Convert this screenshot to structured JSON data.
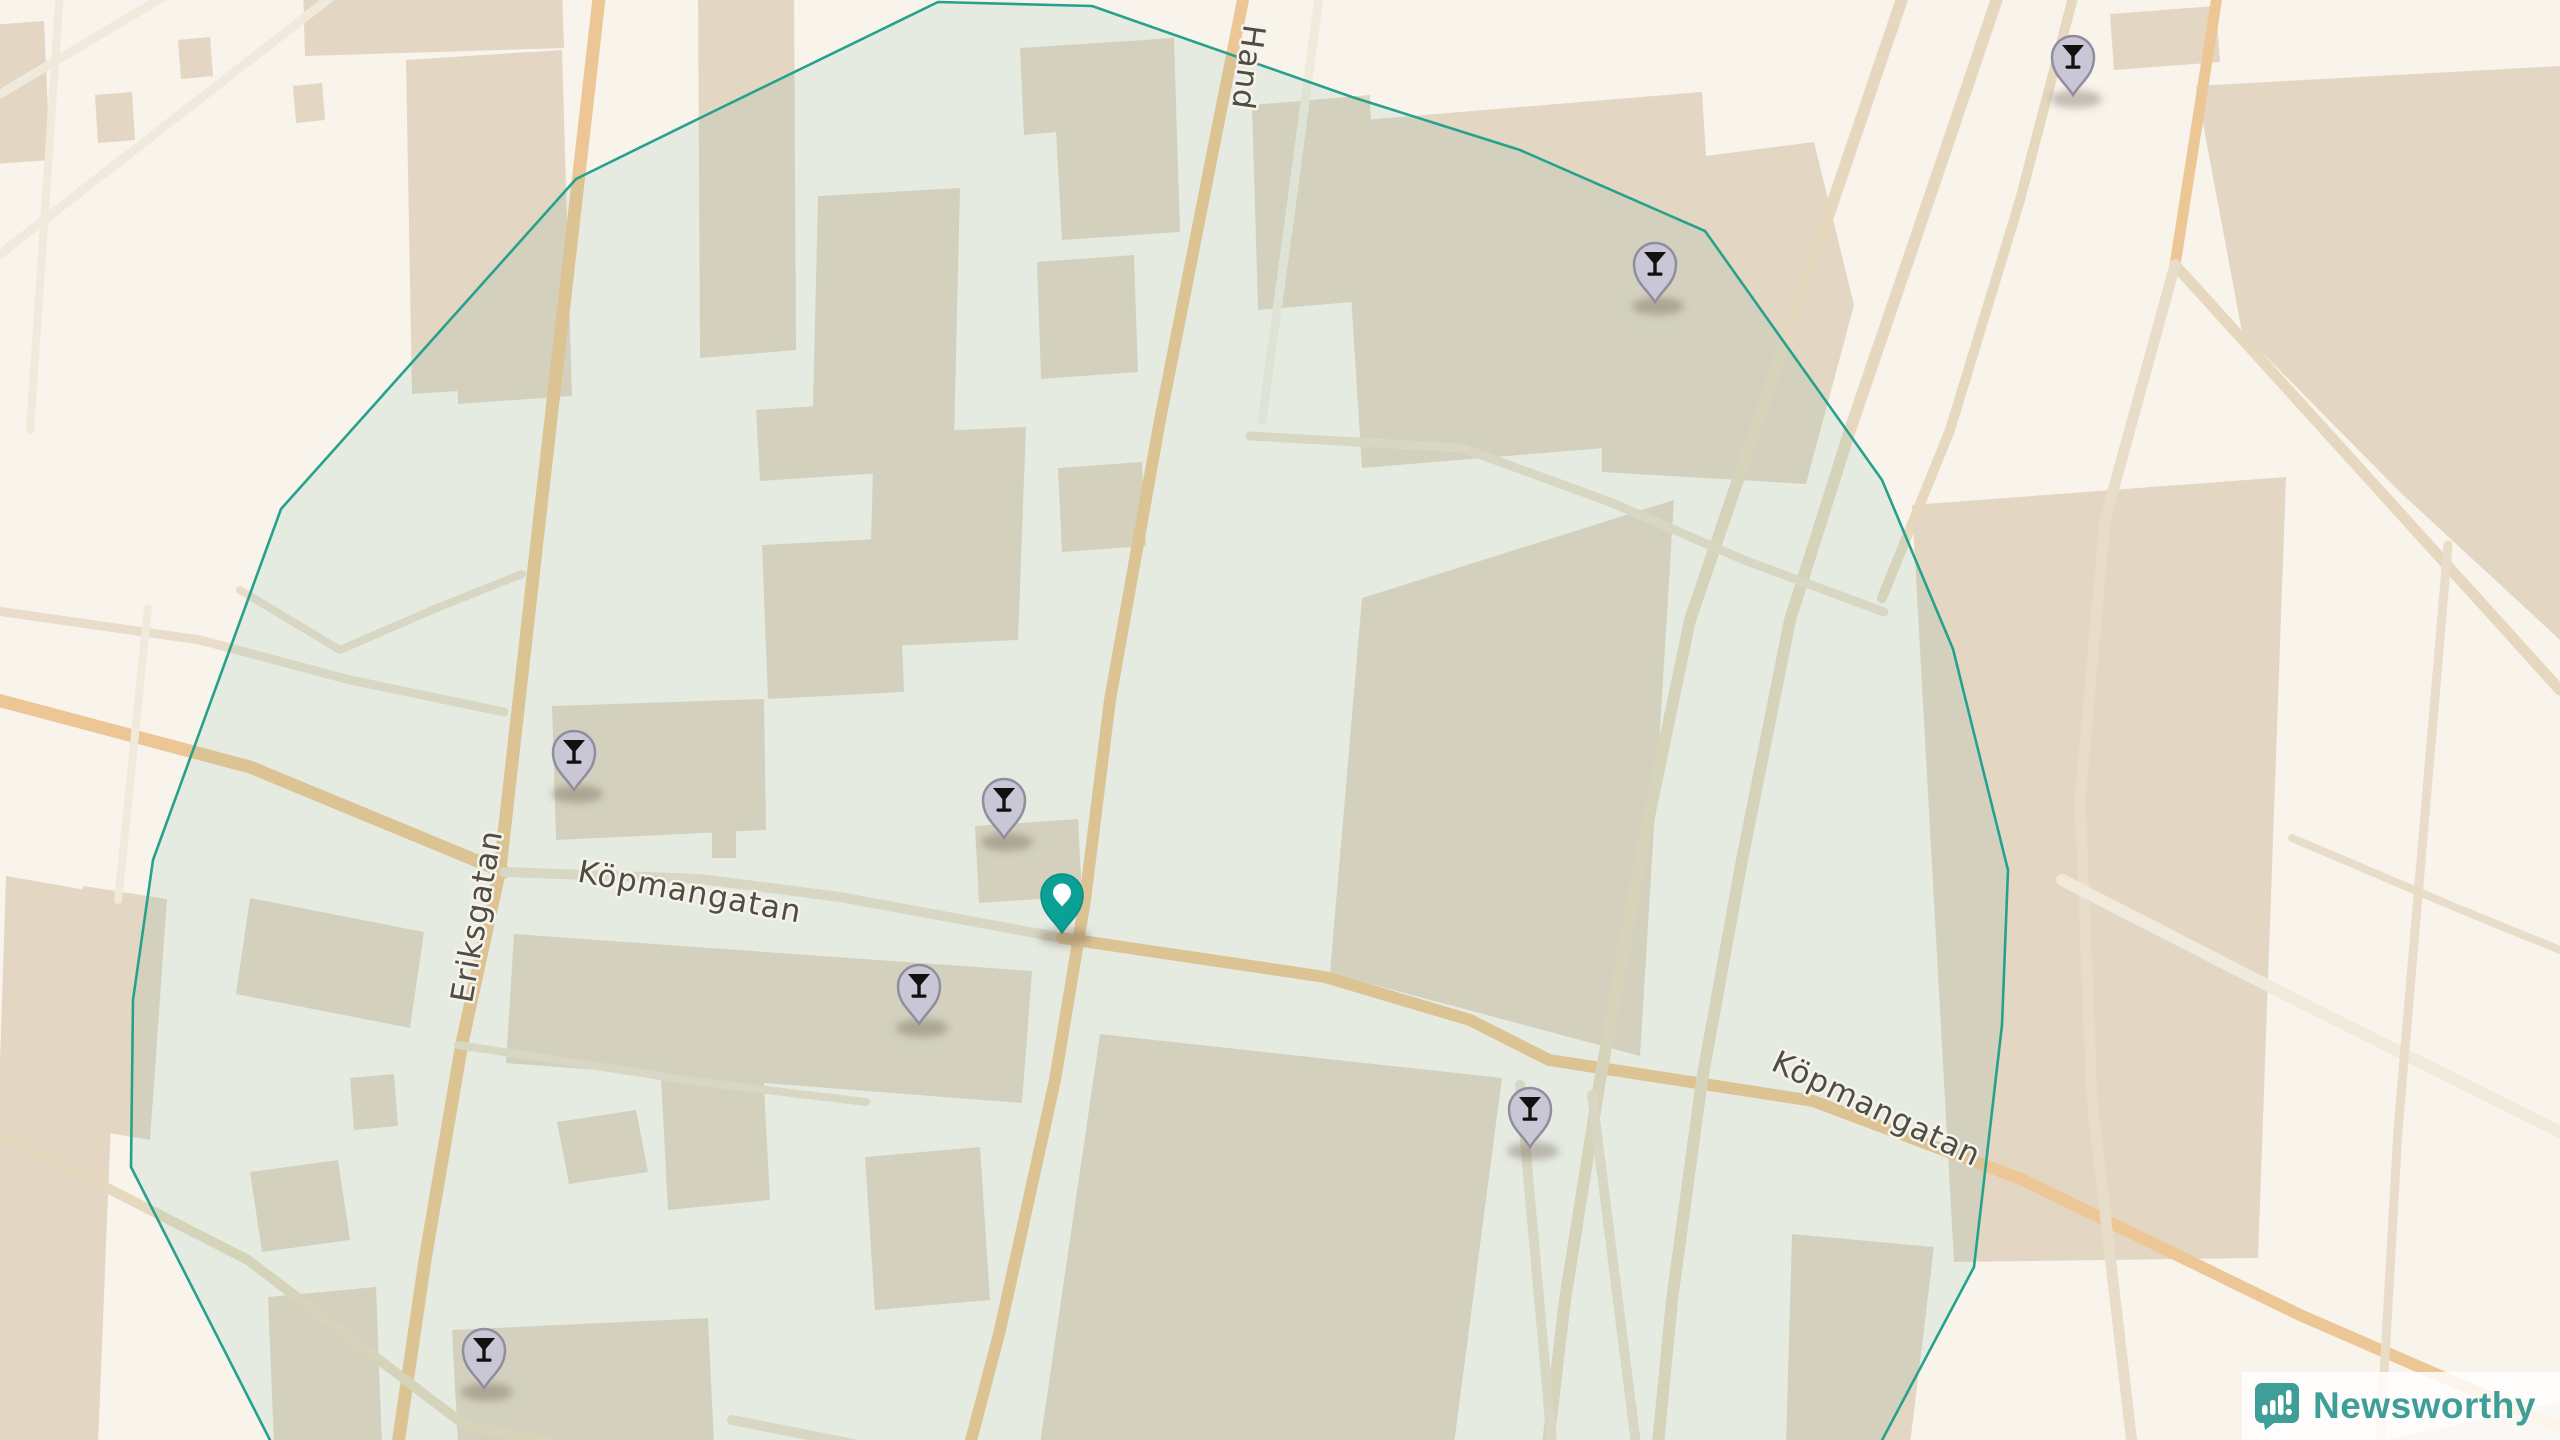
{
  "map": {
    "width": 2560,
    "height": 1440,
    "colors": {
      "bg": "#f8f3eb",
      "building": "#e3d6c3",
      "road_major": "#ecc795",
      "road_paletan": "#e5d8be",
      "road_minor": "#e7ddc9",
      "road_white": "#f0eadd",
      "boundary_stroke": "#26a28c",
      "boundary_fill": "rgba(74,168,150,0.10)",
      "label": "#4e4c44",
      "label_halo": "#f6f3ea",
      "pin_poi_fill": "#c9c7d6",
      "pin_poi_stroke": "#908e9e",
      "pin_poi_glyph": "#111111",
      "pin_origin_fill": "#0ba096",
      "pin_origin_stroke": "#0a8c84"
    },
    "boundary": {
      "points": "938,2 1092,6 1352,97 1520,150 1705,231 1882,480 1953,649 2008,870 2002,1025 1974,1267 1880,1444 272,1444 131,1167 133,1000 153,860 281,509 576,179 700,118"
    },
    "buildings": [
      {
        "points": "95,95 132,92 135,140 98,143"
      },
      {
        "points": "293,86 322,83 325,120 296,123"
      },
      {
        "points": "303,-12 562,-12 564,48 305,56"
      },
      {
        "points": "448,58 562,50 572,396 458,404"
      },
      {
        "points": "698,-12 794,-12 796,350 700,358"
      },
      {
        "points": "2110,14 2216,6 2220,62 2114,70"
      },
      {
        "points": "2196,86 2560,66 2560,640 2400,492 2242,332"
      },
      {
        "points": "1912,505 2286,477 2258,1258 1954,1262"
      },
      {
        "points": "2368,1444 2560,1402 2560,1444"
      },
      {
        "points": "-10,25 44,21 50,160 -6,164"
      },
      {
        "points": "6,876 120,896 98,1444 -12,1440"
      },
      {
        "points": "83,886 167,899 150,1140 68,1126"
      },
      {
        "points": "178,40 210,37 213,76 181,79"
      },
      {
        "points": "406,60 530,52 536,386 412,394"
      },
      {
        "points": "1340,122 1702,92 1724,438 1362,468"
      },
      {
        "points": "1252,105 1370,95 1376,300 1258,310"
      },
      {
        "points": "1598,170 1814,142 1854,305 1806,484 1602,472"
      },
      {
        "points": "1362,598 1674,500 1640,1056 1330,973"
      },
      {
        "points": "1100,1034 1502,1078 1454,1444 1040,1444"
      },
      {
        "points": "818,196 960,188 954,440 812,448"
      },
      {
        "points": "756,410 878,402 882,473 760,481"
      },
      {
        "points": "874,434 1026,427 1018,640 868,647"
      },
      {
        "points": "1037,262 1134,255 1138,372 1041,379"
      },
      {
        "points": "1058,468 1142,462 1146,546 1062,552"
      },
      {
        "points": "1020,48 1174,38 1180,232 1062,240 1056,132 1024,135"
      },
      {
        "points": "552,706 764,699 766,830 556,840"
      },
      {
        "points": "712,830 736,830 736,858 712,858"
      },
      {
        "points": "762,545 898,538 904,692 768,699"
      },
      {
        "points": "975,826 1078,819 1082,896 979,903"
      },
      {
        "points": "514,934 1032,971 1022,1103 506,1063"
      },
      {
        "points": "557,1122 636,1110 648,1172 569,1184"
      },
      {
        "points": "660,1058 762,1048 770,1200 668,1210"
      },
      {
        "points": "865,1157 980,1147 990,1300 875,1310"
      },
      {
        "points": "550,1355 668,1347 674,1444 556,1444"
      },
      {
        "points": "250,1172 338,1160 350,1240 262,1252"
      },
      {
        "points": "350,1078 394,1074 398,1126 354,1130"
      },
      {
        "points": "268,1297 376,1287 382,1444 274,1444"
      },
      {
        "points": "250,898 424,932 410,1028 236,994"
      },
      {
        "points": "452,1330 708,1318 714,1444 458,1444"
      },
      {
        "points": "1792,1234 1934,1247 1910,1444 1786,1444"
      }
    ],
    "roads": [
      {
        "name": "eriksgatan",
        "kind": "road_major",
        "width": 13,
        "points": "600,-10 536,550 500,869 462,1043 425,1260 398,1444"
      },
      {
        "name": "handelsgatan",
        "kind": "road_major",
        "width": 12,
        "points": "1245,-10 1220,115 1160,420 1110,700 1085,900 1055,1080 1000,1330 968,1452"
      },
      {
        "name": "kopmangatan-west",
        "kind": "road_major",
        "width": 13,
        "points": "-10,698 250,767 504,872"
      },
      {
        "name": "kopmangatan-mid",
        "kind": "road_minor",
        "width": 10,
        "points": "504,872 700,879 840,897 1062,938"
      },
      {
        "name": "kopmangatan-east",
        "kind": "road_major",
        "width": 12,
        "points": "1062,938 1325,977 1470,1020 1549,1060 1813,1101 2021,1179 2300,1315 2560,1428"
      },
      {
        "name": "corridor-west",
        "kind": "road_paletan",
        "width": 12,
        "points": "1905,-10 1820,240 1755,430 1690,620 1640,860 1600,1080 1565,1300 1548,1444"
      },
      {
        "name": "corridor-east",
        "kind": "road_paletan",
        "width": 12,
        "points": "2000,-10 1915,240 1850,430 1790,620 1742,860 1702,1080 1672,1300 1658,1444"
      },
      {
        "name": "corridor-branch",
        "kind": "road_paletan",
        "width": 10,
        "points": "2075,-10 2020,200 1950,430 1882,598"
      },
      {
        "name": "northeast-stub",
        "kind": "road_major",
        "width": 11,
        "points": "2218,-10 2175,265"
      },
      {
        "name": "northeast-diagonal",
        "kind": "road_paletan",
        "width": 11,
        "points": "2175,265 2370,480 2560,690"
      },
      {
        "name": "east-field-road",
        "kind": "road_minor",
        "width": 11,
        "points": "2175,265 2105,520 2080,800 2092,1100 2132,1444"
      },
      {
        "name": "southeast-parallel",
        "kind": "road_white",
        "width": 12,
        "points": "2062,880 2300,1002 2560,1132"
      },
      {
        "name": "east-vertical",
        "kind": "road_minor",
        "width": 9,
        "points": "2448,545 2398,1130 2380,1444"
      },
      {
        "name": "east-connector",
        "kind": "road_minor",
        "width": 8,
        "points": "2292,838 2452,906 2560,950"
      },
      {
        "name": "west-connector",
        "kind": "road_minor",
        "width": 9,
        "points": "-10,610 200,640 350,680 504,712"
      },
      {
        "name": "west-branch",
        "kind": "road_minor",
        "width": 8,
        "points": "240,590 340,650 432,610 522,574"
      },
      {
        "name": "north-parallel",
        "kind": "road_white",
        "width": 9,
        "points": "1320,-10 1288,230 1262,420"
      },
      {
        "name": "block-gap-road",
        "kind": "road_minor",
        "width": 9,
        "points": "1250,436 1462,448 1610,502 1744,560 1884,612"
      },
      {
        "name": "south-lane-1",
        "kind": "road_minor",
        "width": 10,
        "points": "1520,1085 1552,1444"
      },
      {
        "name": "south-lane-2",
        "kind": "road_minor",
        "width": 10,
        "points": "1592,1095 1636,1444"
      },
      {
        "name": "southwest-diagonal",
        "kind": "road_paletan",
        "width": 10,
        "points": "-10,1128 248,1260 466,1426 560,1444"
      },
      {
        "name": "south-connector",
        "kind": "road_minor",
        "width": 8,
        "points": "458,1045 700,1082 866,1102"
      },
      {
        "name": "northwest-vertical",
        "kind": "road_white",
        "width": 8,
        "points": "60,-10 30,430"
      },
      {
        "name": "west-vertical",
        "kind": "road_white",
        "width": 8,
        "points": "148,608 118,900"
      },
      {
        "name": "topleft-diag-1",
        "kind": "road_white",
        "width": 9,
        "points": "-10,100 175,-10"
      },
      {
        "name": "topleft-diag-2",
        "kind": "road_white",
        "width": 9,
        "points": "-10,262 340,-10"
      },
      {
        "name": "south-stub",
        "kind": "road_minor",
        "width": 10,
        "points": "732,1420 915,1456"
      }
    ],
    "street_labels": [
      {
        "id": "eriksgatan",
        "text": "Eriksgatan",
        "x": 487,
        "y": 918,
        "rot": -80,
        "size": 31
      },
      {
        "id": "kopmangatan-west",
        "text": "Köpmangatan",
        "x": 688,
        "y": 902,
        "rot": 10.5,
        "size": 31
      },
      {
        "id": "kopmangatan-east",
        "text": "Köpmangatan",
        "x": 1872,
        "y": 1118,
        "rot": 25.5,
        "size": 31
      },
      {
        "id": "handelsgatan",
        "text": "Hand",
        "x": 1238,
        "y": 66,
        "rot": 98,
        "size": 31
      }
    ],
    "pins": [
      {
        "kind": "bar",
        "tip": [
          2073,
          95
        ]
      },
      {
        "kind": "bar",
        "tip": [
          1655,
          302
        ]
      },
      {
        "kind": "bar",
        "tip": [
          574,
          790
        ]
      },
      {
        "kind": "bar",
        "tip": [
          1004,
          838
        ]
      },
      {
        "kind": "origin",
        "tip": [
          1062,
          933
        ]
      },
      {
        "kind": "bar",
        "tip": [
          919,
          1024
        ]
      },
      {
        "kind": "bar",
        "tip": [
          1530,
          1147
        ]
      },
      {
        "kind": "bar",
        "tip": [
          484,
          1388
        ]
      }
    ]
  },
  "logo": {
    "text": "Newsworthy"
  }
}
